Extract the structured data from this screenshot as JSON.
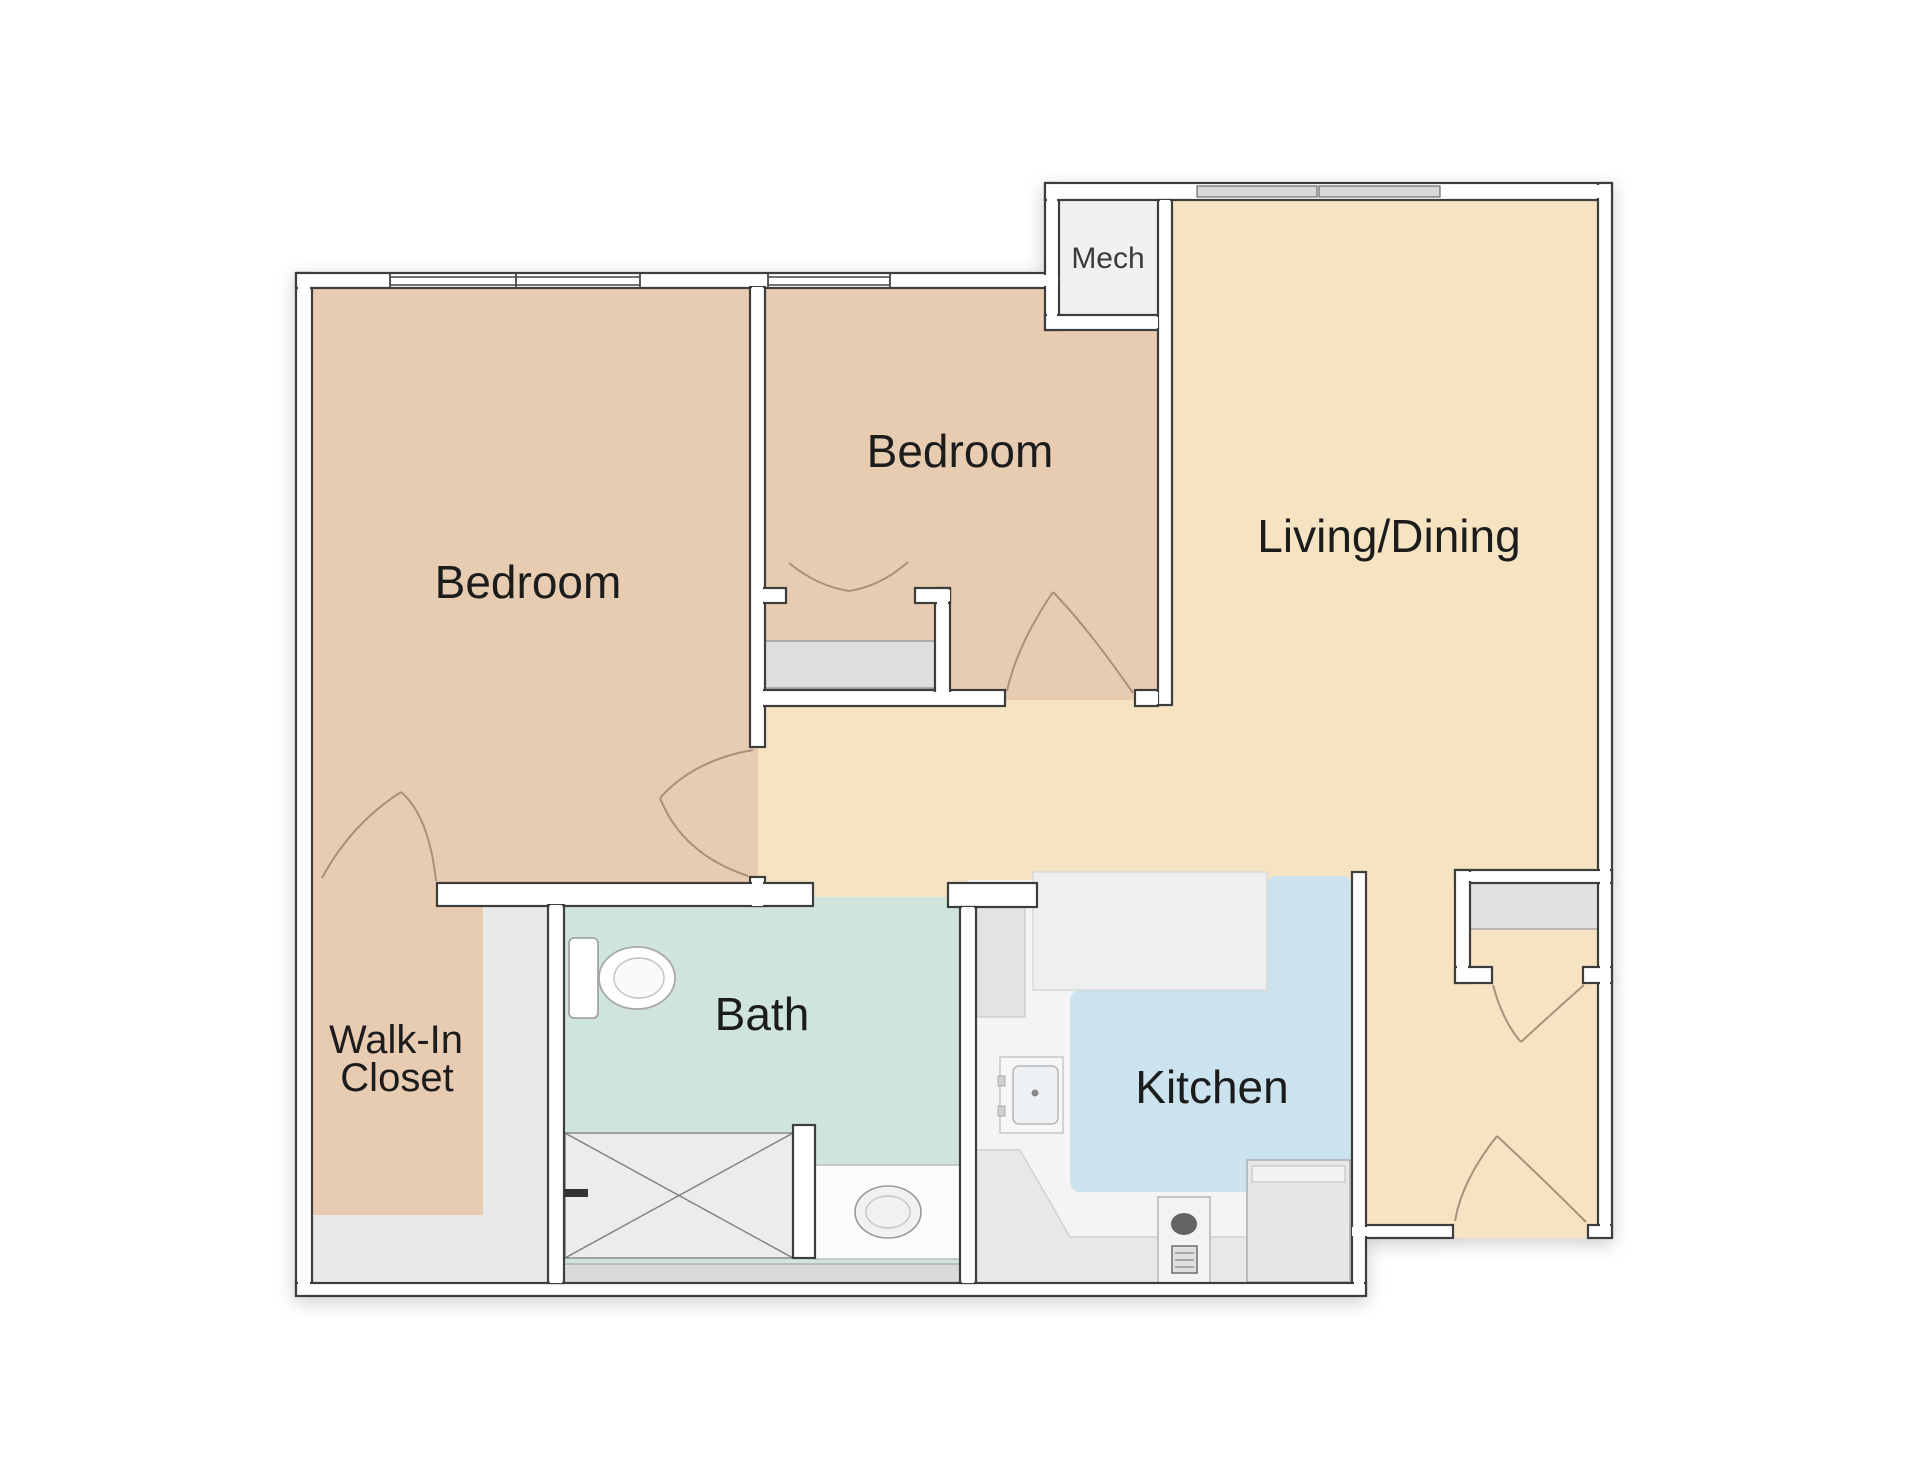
{
  "plan": {
    "labels": {
      "bedroom_1": "Bedroom",
      "bedroom_2": "Bedroom",
      "living_dining": "Living/Dining",
      "bath": "Bath",
      "kitchen": "Kitchen",
      "walk_in_closet_line_1": "Walk-In",
      "walk_in_closet_line_2": "Closet",
      "mech": "Mech"
    },
    "colors": {
      "bedroom_floor": "#e8ccb2",
      "living_floor": "#f5e3c1",
      "hall_floor": "#f5e3c1",
      "bath_floor": "#cfe5db",
      "kitchen_floor": "#cbe2ef",
      "kitchen_base": "#f4f4f4",
      "closet_gray": "#e9e9e9",
      "mech_floor": "#f0f0f0",
      "counter_gray": "#e8e8e8",
      "shelf_gray": "#e0e0e0",
      "wall_fill": "#ffffff",
      "wall_line": "#3d3d3d",
      "window_gray": "#d9d9d9",
      "fixture_line": "#9a9a9a",
      "door_arc": "#a8917c",
      "label_text": "#1f1f1f"
    }
  }
}
